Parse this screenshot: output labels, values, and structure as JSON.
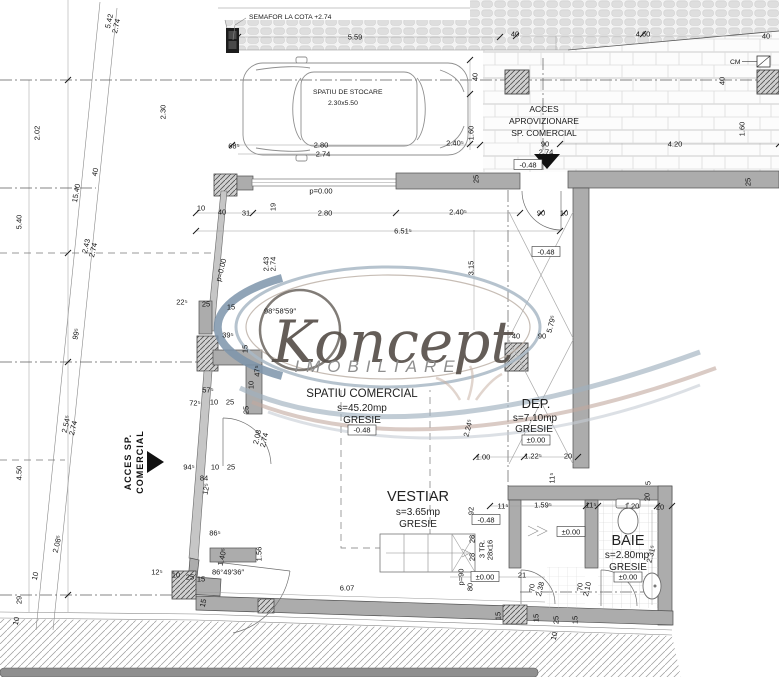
{
  "watermark": {
    "brand": "Koncept",
    "subtitle": "IMOBILIARE"
  },
  "rooms": {
    "comercial": {
      "name": "SPATIU COMERCIAL",
      "area": "s=45.20mp",
      "finish": "GRESIE",
      "level": "-0.48"
    },
    "dep": {
      "name": "DEP.",
      "area": "s=7.10mp",
      "finish": "GRESIE",
      "level": "±0.00"
    },
    "vestiar": {
      "name": "VESTIAR",
      "area": "s=3.65mp",
      "finish": "GRESIE"
    },
    "baie": {
      "name": "BAIE",
      "area": "s=2.80mp",
      "finish": "GRESIE",
      "level": "±0.00"
    }
  },
  "annotations": {
    "semafor": "SEMAFOR LA COTA +2.74",
    "storage_title": "SPATIU DE STOCARE",
    "storage_size": "2.30x5.50",
    "supply_access_1": "ACCES",
    "supply_access_2": "APROVIZIONARE",
    "supply_access_3": "SP. COMERCIAL",
    "shop_access_1": "ACCES SP.",
    "shop_access_2": "COMERCIAL",
    "meter": "CM"
  },
  "colors": {
    "wall_grey": "#acacac",
    "watermark_brown": "#57504a",
    "watermark_blue": "#8ba0b4",
    "watermark_pink": "#c2a99e"
  },
  "dims": [
    {
      "t": "5.59",
      "x": 355,
      "y": 37
    },
    {
      "t": "40",
      "x": 515,
      "y": 34
    },
    {
      "t": "4.60",
      "x": 643,
      "y": 34
    },
    {
      "t": "40",
      "x": 766,
      "y": 36
    },
    {
      "t": "2.30",
      "x": 163,
      "y": 112,
      "r": -90
    },
    {
      "t": "5.42",
      "x": 109,
      "y": 21,
      "r": -77
    },
    {
      "t": "2.74",
      "x": 116,
      "y": 26,
      "r": -77
    },
    {
      "t": "2.02",
      "x": 37,
      "y": 133,
      "r": -90
    },
    {
      "t": "5.40",
      "x": 19,
      "y": 222,
      "r": -90
    },
    {
      "t": "15.40",
      "x": 76,
      "y": 193,
      "r": -80
    },
    {
      "t": "40",
      "x": 95,
      "y": 172,
      "r": -77
    },
    {
      "t": "2.43",
      "x": 86,
      "y": 246,
      "r": -77
    },
    {
      "t": "2.74",
      "x": 93,
      "y": 250,
      "r": -77
    },
    {
      "t": "99⁵",
      "x": 76,
      "y": 334,
      "r": -77
    },
    {
      "t": "2.54⁵",
      "x": 66,
      "y": 424,
      "r": -77
    },
    {
      "t": "2.74",
      "x": 73,
      "y": 428,
      "r": -77
    },
    {
      "t": "4.50",
      "x": 19,
      "y": 473,
      "r": -90
    },
    {
      "t": "2.08⁵",
      "x": 57,
      "y": 544,
      "r": -77
    },
    {
      "t": "10",
      "x": 35,
      "y": 576,
      "r": -77
    },
    {
      "t": "29",
      "x": 19,
      "y": 600,
      "r": -90
    },
    {
      "t": "10",
      "x": 16,
      "y": 621,
      "r": -77
    },
    {
      "t": "68⁵",
      "x": 234,
      "y": 146
    },
    {
      "t": "2.80",
      "x": 321,
      "y": 145
    },
    {
      "t": "2.74",
      "x": 323,
      "y": 154
    },
    {
      "t": "2.40⁵",
      "x": 455,
      "y": 143
    },
    {
      "t": "1.60",
      "x": 471,
      "y": 133,
      "r": -90
    },
    {
      "t": "40",
      "x": 475,
      "y": 77,
      "r": -90
    },
    {
      "t": "90",
      "x": 545,
      "y": 144
    },
    {
      "t": "2.74",
      "x": 546,
      "y": 152
    },
    {
      "t": "-0.48",
      "x": 528,
      "y": 165,
      "b": 1
    },
    {
      "t": "4.20",
      "x": 675,
      "y": 144
    },
    {
      "t": "1.60",
      "x": 742,
      "y": 129,
      "r": -90
    },
    {
      "t": "40",
      "x": 722,
      "y": 81,
      "r": -90
    },
    {
      "t": "25",
      "x": 748,
      "y": 182,
      "r": -90
    },
    {
      "t": "p=0.00",
      "x": 321,
      "y": 191
    },
    {
      "t": "10",
      "x": 201,
      "y": 208
    },
    {
      "t": "40",
      "x": 222,
      "y": 212
    },
    {
      "t": "31",
      "x": 246,
      "y": 213
    },
    {
      "t": "19",
      "x": 273,
      "y": 207,
      "r": -90
    },
    {
      "t": "2.80",
      "x": 325,
      "y": 213
    },
    {
      "t": "2.40⁵",
      "x": 458,
      "y": 212
    },
    {
      "t": "6.51⁵",
      "x": 403,
      "y": 231
    },
    {
      "t": "25",
      "x": 476,
      "y": 179,
      "r": -90
    },
    {
      "t": "2.43",
      "x": 266,
      "y": 264,
      "r": -90
    },
    {
      "t": "2.74",
      "x": 273,
      "y": 264,
      "r": -90
    },
    {
      "t": "p=0.00",
      "x": 221,
      "y": 270,
      "r": -75
    },
    {
      "t": "3.15",
      "x": 471,
      "y": 268,
      "r": -90
    },
    {
      "t": "90",
      "x": 541,
      "y": 213
    },
    {
      "t": "10",
      "x": 564,
      "y": 213
    },
    {
      "t": "-0.48",
      "x": 546,
      "y": 252,
      "b": 1
    },
    {
      "t": "22⁵",
      "x": 182,
      "y": 302
    },
    {
      "t": "25",
      "x": 206,
      "y": 304
    },
    {
      "t": "15",
      "x": 231,
      "y": 307
    },
    {
      "t": "98°58′59″",
      "x": 280,
      "y": 311
    },
    {
      "t": "39⁵",
      "x": 228,
      "y": 335
    },
    {
      "t": "15",
      "x": 245,
      "y": 349,
      "r": -90
    },
    {
      "t": "47⁵",
      "x": 257,
      "y": 371,
      "r": -90
    },
    {
      "t": "10",
      "x": 251,
      "y": 385,
      "r": -90
    },
    {
      "t": "25",
      "x": 246,
      "y": 410,
      "r": -90
    },
    {
      "t": "57⁵",
      "x": 208,
      "y": 390
    },
    {
      "t": "72⁵",
      "x": 195,
      "y": 403
    },
    {
      "t": "10",
      "x": 214,
      "y": 402
    },
    {
      "t": "25",
      "x": 230,
      "y": 402
    },
    {
      "t": "2.08",
      "x": 257,
      "y": 437,
      "r": -77
    },
    {
      "t": "2.74",
      "x": 264,
      "y": 440,
      "r": -77
    },
    {
      "t": "94⁵",
      "x": 189,
      "y": 467
    },
    {
      "t": "10",
      "x": 215,
      "y": 467
    },
    {
      "t": "25",
      "x": 231,
      "y": 467
    },
    {
      "t": "84",
      "x": 204,
      "y": 478
    },
    {
      "t": "12⁵",
      "x": 206,
      "y": 489,
      "r": -77
    },
    {
      "t": "86⁵",
      "x": 215,
      "y": 533
    },
    {
      "t": "1.40⁵",
      "x": 222,
      "y": 557,
      "r": -77
    },
    {
      "t": "1.56",
      "x": 259,
      "y": 554,
      "r": -90
    },
    {
      "t": "12⁵",
      "x": 157,
      "y": 572
    },
    {
      "t": "10",
      "x": 176,
      "y": 575
    },
    {
      "t": "25",
      "x": 190,
      "y": 577
    },
    {
      "t": "15",
      "x": 201,
      "y": 579
    },
    {
      "t": "86°49′36″",
      "x": 228,
      "y": 572
    },
    {
      "t": "15",
      "x": 203,
      "y": 603,
      "r": -77
    },
    {
      "t": "40",
      "x": 516,
      "y": 336
    },
    {
      "t": "90",
      "x": 542,
      "y": 336
    },
    {
      "t": "5.79⁵",
      "x": 551,
      "y": 324,
      "r": -75
    },
    {
      "t": "2.24⁵",
      "x": 468,
      "y": 428,
      "r": -75
    },
    {
      "t": "1.00",
      "x": 483,
      "y": 457
    },
    {
      "t": "1.22⁵",
      "x": 533,
      "y": 456
    },
    {
      "t": "20",
      "x": 568,
      "y": 456
    },
    {
      "t": "11⁵",
      "x": 552,
      "y": 478,
      "r": -90
    },
    {
      "t": "11⁵",
      "x": 503,
      "y": 506
    },
    {
      "t": "1.59⁵",
      "x": 543,
      "y": 505
    },
    {
      "t": "11⁵",
      "x": 591,
      "y": 505
    },
    {
      "t": "1.20",
      "x": 632,
      "y": 506
    },
    {
      "t": "20",
      "x": 660,
      "y": 507
    },
    {
      "t": "5",
      "x": 648,
      "y": 483,
      "r": -90
    },
    {
      "t": "20",
      "x": 647,
      "y": 497,
      "r": -90
    },
    {
      "t": "92",
      "x": 471,
      "y": 511,
      "r": -90
    },
    {
      "t": "-0.48",
      "x": 486,
      "y": 520,
      "b": 1
    },
    {
      "t": "28",
      "x": 472,
      "y": 539,
      "r": -90
    },
    {
      "t": "28",
      "x": 472,
      "y": 557,
      "r": -90
    },
    {
      "t": "3 TR.",
      "x": 482,
      "y": 549,
      "r": -90
    },
    {
      "t": "28x16",
      "x": 490,
      "y": 550,
      "r": -90
    },
    {
      "t": "p=90",
      "x": 461,
      "y": 577,
      "r": -90
    },
    {
      "t": "±0.00",
      "x": 485,
      "y": 577,
      "b": 1
    },
    {
      "t": "80",
      "x": 470,
      "y": 587,
      "r": -90
    },
    {
      "t": "21",
      "x": 522,
      "y": 575
    },
    {
      "t": "70",
      "x": 532,
      "y": 588,
      "r": -90
    },
    {
      "t": "2.38",
      "x": 540,
      "y": 589,
      "r": -77
    },
    {
      "t": "±0.00",
      "x": 571,
      "y": 532,
      "b": 1
    },
    {
      "t": "2.31⁵",
      "x": 651,
      "y": 554,
      "r": -75
    },
    {
      "t": "70",
      "x": 580,
      "y": 587,
      "r": -90
    },
    {
      "t": "2.10",
      "x": 587,
      "y": 589,
      "r": -77
    },
    {
      "t": "15",
      "x": 575,
      "y": 620,
      "r": -90
    },
    {
      "t": "6.07",
      "x": 347,
      "y": 588
    },
    {
      "t": "15",
      "x": 498,
      "y": 616,
      "r": -90
    },
    {
      "t": "15",
      "x": 536,
      "y": 618,
      "r": -90
    },
    {
      "t": "25",
      "x": 556,
      "y": 620,
      "r": -90
    },
    {
      "t": "10",
      "x": 554,
      "y": 636,
      "r": -77
    }
  ]
}
